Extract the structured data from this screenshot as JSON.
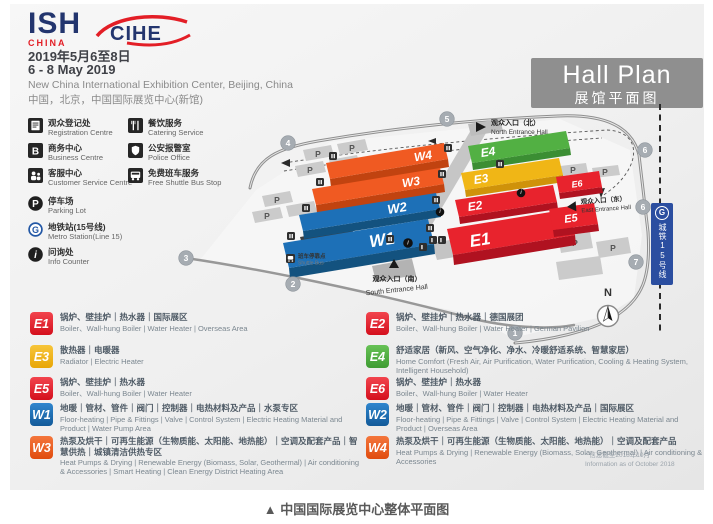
{
  "header": {
    "logo_ish": {
      "text": "ISH",
      "sub": "CHINA"
    },
    "logo_cihe": "CIHE",
    "date_zh": "2019年5月6至8日",
    "date_en": "6 - 8 May 2019",
    "venue_en": "New China International Exhibition Center, Beijing, China",
    "venue_zh": "中国，北京，中国国际展览中心(新馆)",
    "hall_plan_en": "Hall Plan",
    "hall_plan_zh": "展馆平面图"
  },
  "facilities": {
    "col1": [
      {
        "icon": "registration-icon",
        "zh": "观众登记处",
        "en": "Registration Centre"
      },
      {
        "icon": "business-icon",
        "zh": "商务中心",
        "en": "Business Centre"
      },
      {
        "icon": "customer-service-icon",
        "zh": "客服中心",
        "en": "Customer Service Centre"
      },
      {
        "icon": "parking-icon",
        "zh": "停车场",
        "en": "Parking Lot"
      },
      {
        "icon": "metro-icon",
        "zh": "地铁站(15号线)",
        "en": "Metro Station(Line 15)"
      },
      {
        "icon": "info-icon",
        "zh": "问询处",
        "en": "Info Counter"
      }
    ],
    "col2": [
      {
        "icon": "catering-icon",
        "zh": "餐饮服务",
        "en": "Catering Service"
      },
      {
        "icon": "police-icon",
        "zh": "公安报警室",
        "en": "Police Office"
      },
      {
        "icon": "shuttle-bus-icon",
        "zh": "免费班车服务",
        "en": "Free Shuttle Bus Stop"
      }
    ]
  },
  "map": {
    "hall_labels": [
      "W1",
      "W2",
      "W3",
      "W4",
      "E1",
      "E2",
      "E3",
      "E4",
      "E5",
      "E6"
    ],
    "entrances": {
      "north": {
        "zh": "观众入口（北）",
        "en": "North Entrance Hall"
      },
      "south": {
        "zh": "观众入口（南）",
        "en": "South Entrance Hall"
      },
      "east": {
        "zh": "观众入口（东）",
        "en": "East Entrance Hall"
      }
    },
    "metro_line_banner": "城铁15号线",
    "metro_logo_letter": "G",
    "shuttle_stop": {
      "zh": "班车停靠点",
      "en": "Shuttle Bus"
    },
    "parking_label": "P",
    "compass_label": "N",
    "road_markers": [
      "1",
      "2",
      "3",
      "4",
      "5",
      "6",
      "6",
      "7"
    ]
  },
  "legend": [
    {
      "code": "E1",
      "color": "#e8232d",
      "zh": "锅炉、壁挂炉｜热水器｜国际展区",
      "en": "Boiler、Wall-hung Boiler | Water Heater | Overseas Area"
    },
    {
      "code": "E2",
      "color": "#e8232d",
      "zh": "锅炉、壁挂炉｜热水器｜德国展团",
      "en": "Boiler、Wall-hung Boiler | Water Heater | German Pavilion"
    },
    {
      "code": "E3",
      "color": "#f0b616",
      "zh": "散热器｜电暖器",
      "en": "Radiator | Electric Heater"
    },
    {
      "code": "E4",
      "color": "#52b043",
      "zh": "舒适家居（新风、空气净化、净水、冷暖舒适系统、智慧家居）",
      "en": "Home Comfort (Fresh Air, Air Purification, Water Purification, Cooling & Heating System, Intelligent Household)"
    },
    {
      "code": "E5",
      "color": "#e8232d",
      "zh": "锅炉、壁挂炉｜热水器",
      "en": "Boiler、Wall-hung Boiler | Water Heater"
    },
    {
      "code": "E6",
      "color": "#e8232d",
      "zh": "锅炉、壁挂炉｜热水器",
      "en": "Boiler、Wall-hung Boiler | Water Heater"
    },
    {
      "code": "W1",
      "color": "#1d70b7",
      "zh": "地暖｜管材、管件｜阀门｜控制器｜电热材料及产品｜水泵专区",
      "en": "Floor-heating | Pipe & Fittings | Valve | Control System | Electric Heating Material and Product | Water Pump Area"
    },
    {
      "code": "W2",
      "color": "#1d70b7",
      "zh": "地暖｜管材、管件｜阀门｜控制器｜电热材料及产品｜国际展区",
      "en": "Floor-heating | Pipe & Fittings | Valve | Control System | Electric Heating Material and Product | Overseas Area"
    },
    {
      "code": "W3",
      "color": "#f05a22",
      "zh": "热泵及烘干｜可再生能源（生物质能、太阳能、地热能）｜空调及配套产品｜智慧供热｜城镇清洁供热专区",
      "en": "Heat Pumps & Drying | Renewable Energy (Biomass, Solar, Geothermal) | Air conditioning & Accessories | Smart Heating | Clean Energy District Heating Area"
    },
    {
      "code": "W4",
      "color": "#f05a22",
      "zh": "热泵及烘干｜可再生能源（生物质能、太阳能、地热能）｜空调及配套产品",
      "en": "Heat Pumps & Drying | Renewable Energy (Biomass, Solar, Geothermal) | Air conditioning & Accessories"
    }
  ],
  "footnote_zh": "* 信息截至2018年10月",
  "footnote_en": "Information as of October 2018",
  "caption_marker": "▲",
  "caption": "中国国际展览中心整体平面图",
  "colors": {
    "red": "#e8232d",
    "yellow": "#f0b616",
    "green": "#52b043",
    "blue": "#1d70b7",
    "orange": "#f05a22",
    "brand_red": "#e31e26",
    "brand_navy": "#23356e",
    "hall_plan_gray": "#8f8f8f",
    "metro_blue": "#2b4ea0"
  }
}
